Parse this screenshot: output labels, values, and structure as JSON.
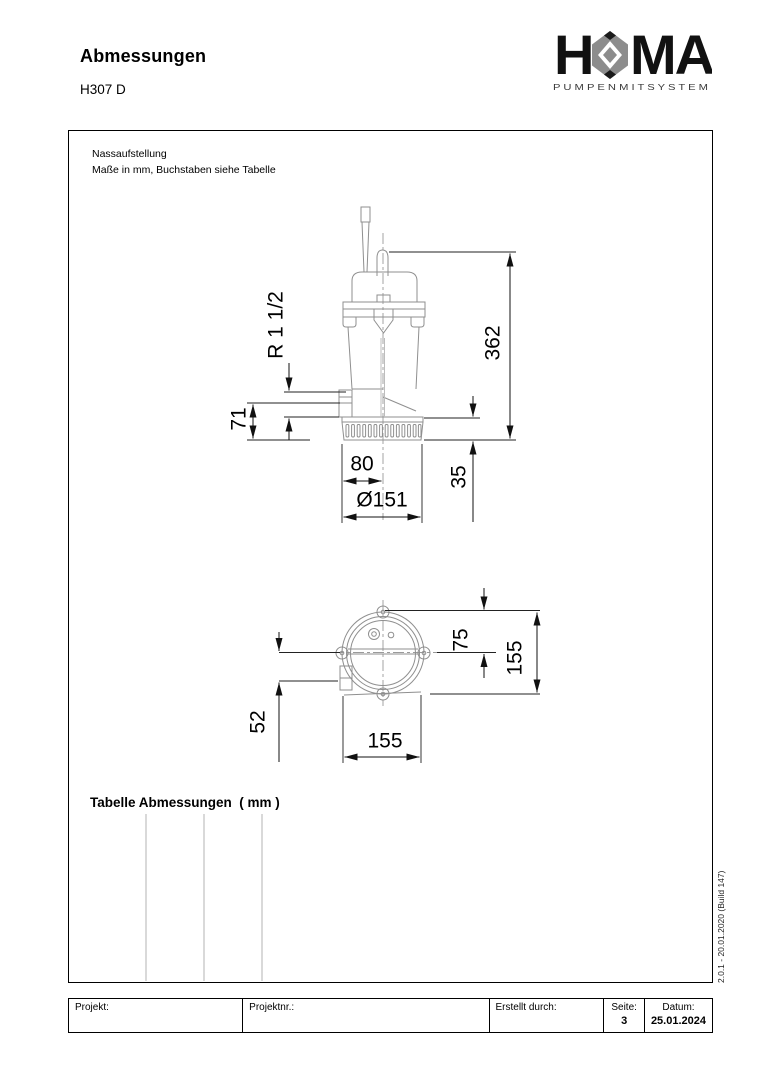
{
  "page": {
    "title": "Abmessungen",
    "model": "H307 D"
  },
  "logo": {
    "word_left": "H",
    "word_right": "MA",
    "tagline": "P U M P E N   M I T   S Y S T E M",
    "hex_color": "#8c8c8c",
    "text_color": "#111111"
  },
  "drawing": {
    "note_line1": "Nassaufstellung",
    "note_line2": "Maße in mm, Buchstaben siehe Tabelle",
    "table_heading": "Tabelle Abmessungen  ( mm )",
    "version_note": "2.0.1 - 20.01.2020 (Build 147)",
    "front_view": {
      "thread": "R 1 1/2",
      "total_height": "362",
      "outlet_height": "71",
      "outlet_to_center": "80",
      "diameter": "Ø151",
      "base_height": "35"
    },
    "top_view": {
      "center_offset": "75",
      "overall_height": "155",
      "outlet_offset": "52",
      "overall_width": "155"
    }
  },
  "footer": {
    "project_label": "Projekt:",
    "project_no_label": "Projektnr.:",
    "created_by_label": "Erstellt durch:",
    "page_label": "Seite:",
    "page_value": "3",
    "date_label": "Datum:",
    "date_value": "25.01.2024"
  }
}
